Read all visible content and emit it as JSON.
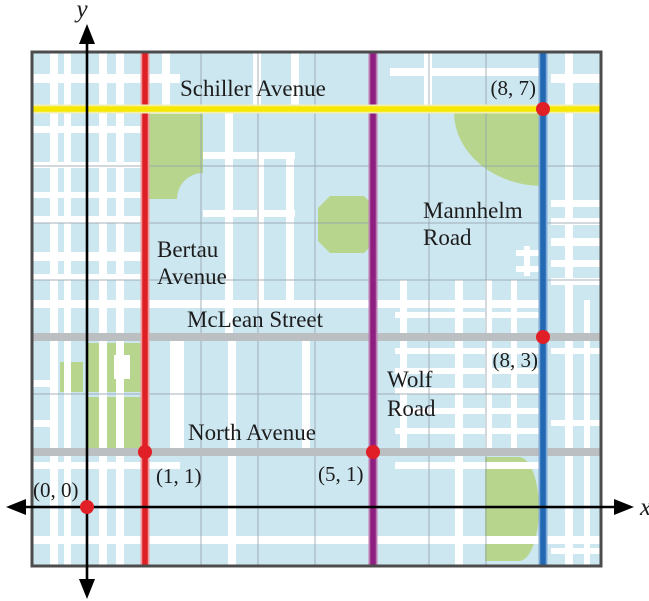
{
  "axes": {
    "x_label": "x",
    "y_label": "y"
  },
  "map": {
    "background_color": "#cde7f1",
    "park_color": "#b7d58c",
    "street_color": "#ffffff",
    "grid_color": "#95a4ad",
    "frame_color": "#4c4c4c",
    "point_color": "#e01f26",
    "minor_road_color": "#bcbfc1"
  },
  "roads": [
    {
      "name": "Schiller Avenue",
      "lines": [
        "Schiller Avenue"
      ],
      "orientation": "horizontal",
      "position": 7,
      "color": "#f6e800"
    },
    {
      "name": "Bertau Avenue",
      "lines": [
        "Bertau",
        "Avenue"
      ],
      "orientation": "vertical",
      "position": 1,
      "color": "#dd2026"
    },
    {
      "name": "McLean Street",
      "lines": [
        "McLean Street"
      ],
      "orientation": "horizontal",
      "position": 3,
      "color": "#bcbfc1"
    },
    {
      "name": "North Avenue",
      "lines": [
        "North Avenue"
      ],
      "orientation": "horizontal",
      "position": 1,
      "color": "#bcbfc1"
    },
    {
      "name": "Wolf Road",
      "lines": [
        "Wolf",
        "Road"
      ],
      "orientation": "vertical",
      "position": 5,
      "color": "#8d1f80"
    },
    {
      "name": "Mannhelm Road",
      "lines": [
        "Mannhelm",
        "Road"
      ],
      "orientation": "vertical",
      "position": 8,
      "color": "#2268b2"
    }
  ],
  "points": [
    {
      "label": "(0, 0)",
      "x": 0,
      "y": 0
    },
    {
      "label": "(1, 1)",
      "x": 1,
      "y": 1
    },
    {
      "label": "(5, 1)",
      "x": 5,
      "y": 1
    },
    {
      "label": "(8, 3)",
      "x": 8,
      "y": 3
    },
    {
      "label": "(8, 7)",
      "x": 8,
      "y": 7
    }
  ]
}
